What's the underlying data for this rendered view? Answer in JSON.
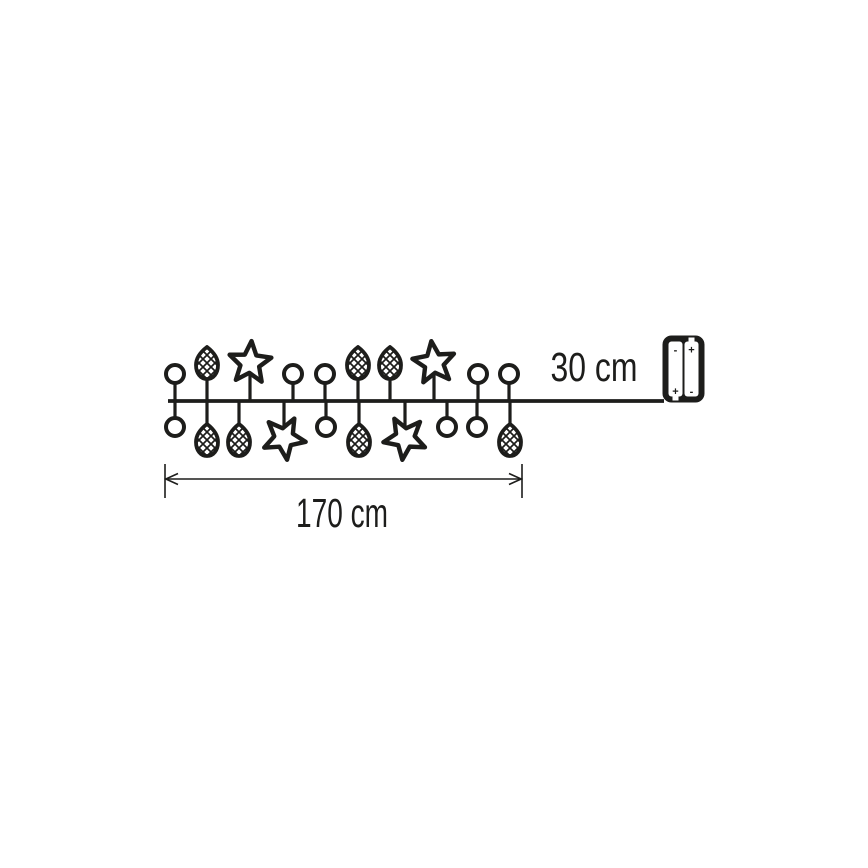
{
  "diagram": {
    "kind": "string-lights-product-dimension-diagram",
    "colors": {
      "ink": "#1d1d1b",
      "background": "#ffffff"
    },
    "labels": {
      "lead_length": "30 cm",
      "chain_length": "170 cm"
    },
    "battery": {
      "cells": [
        {
          "top_terminal": "-",
          "bottom_terminal": "+"
        },
        {
          "top_terminal": "+",
          "bottom_terminal": "-"
        }
      ]
    },
    "chain": {
      "wire_y": 401,
      "wire_x1": 168,
      "wire_x2": 664,
      "ornaments_above": [
        {
          "type": "circle",
          "x": 175
        },
        {
          "type": "pinecone",
          "x": 207
        },
        {
          "type": "star",
          "x": 250,
          "rot": 4
        },
        {
          "type": "circle",
          "x": 293
        },
        {
          "type": "circle",
          "x": 325
        },
        {
          "type": "pinecone",
          "x": 358
        },
        {
          "type": "pinecone",
          "x": 390
        },
        {
          "type": "star",
          "x": 434,
          "rot": -7
        },
        {
          "type": "circle",
          "x": 478
        },
        {
          "type": "circle",
          "x": 509
        }
      ],
      "ornaments_below": [
        {
          "type": "circle",
          "x": 175
        },
        {
          "type": "pinecone",
          "x": 207
        },
        {
          "type": "pinecone",
          "x": 239
        },
        {
          "type": "star",
          "x": 284,
          "rot": 172
        },
        {
          "type": "circle",
          "x": 326
        },
        {
          "type": "pinecone",
          "x": 359
        },
        {
          "type": "star",
          "x": 405,
          "rot": 187
        },
        {
          "type": "circle",
          "x": 447
        },
        {
          "type": "circle",
          "x": 477
        },
        {
          "type": "pinecone",
          "x": 510
        }
      ]
    },
    "dimension": {
      "x1": 165,
      "x2": 522,
      "y": 479
    }
  }
}
